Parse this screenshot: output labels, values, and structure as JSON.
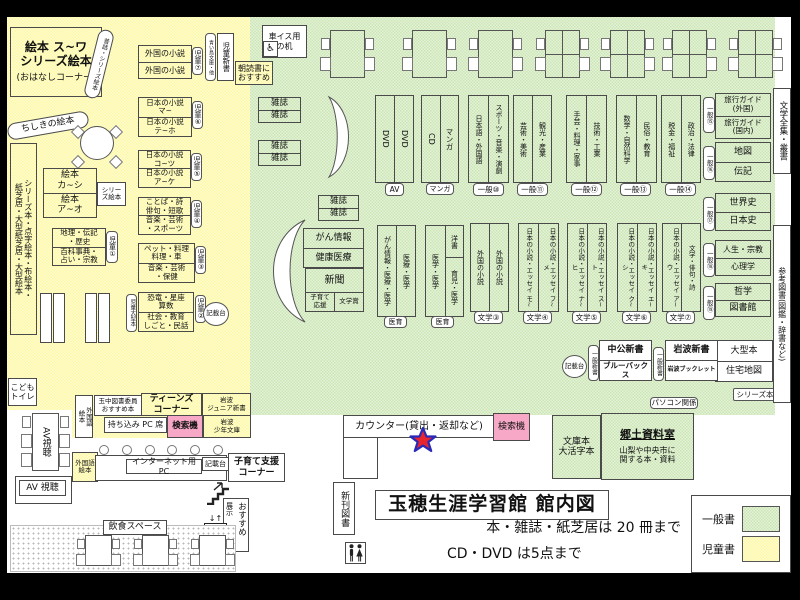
{
  "colors": {
    "children_zone": "#fcf9a2",
    "general_zone": "#cbe5b5",
    "search_machine": "#f6a8c6",
    "star_fill": "#e8252d",
    "star_outline": "#2a2ab8"
  },
  "legend": {
    "general_label": "一般書",
    "children_label": "児童書"
  },
  "title": {
    "main": "玉穂生涯学習館 館内図",
    "note1": "本・雑誌・紙芝居は 20 冊まで",
    "note2": "CD・DVD は5点まで"
  },
  "icons": {
    "wheelchair": "♿",
    "elevator_arrows": "↓↑"
  },
  "children": {
    "corner_line1": "絵本 ス~ワ",
    "corner_line2": "シリーズ絵本",
    "corner_sub": "(おはなしコーナー)",
    "corner_curve": "昔話・シリーズ絵本",
    "chishiki": "ちしきの絵本",
    "series_bar": "シリーズ本・点字絵本・布絵本・\n紙芝居・大型紙芝居・大型絵本",
    "foreign": {
      "a": "外国の小説",
      "b": "外国の小説",
      "tag": "児童⑦"
    },
    "aoitori": "青い鳥文庫・他",
    "jido_shinsho": "児童新書",
    "asadoku": "朝読書に\nおすすめ",
    "jp1": {
      "a": "日本の小説\nマ~",
      "b": "日本の小説\nテ~ホ",
      "tag": "児童⑥"
    },
    "jp2": {
      "a": "日本の小説\nコ~ツ",
      "b": "日本の小説\nア~ケ",
      "tag": "児童⑤"
    },
    "kotoba": {
      "a": "ことば・詩\n俳句・短歌",
      "b": "音楽・芸術\n・スポーツ",
      "tag": "児童④"
    },
    "pet": {
      "a": "ペット・料理\n料理・車",
      "b": "音楽・芸術\n・保健",
      "tag": "児童③"
    },
    "kyoryu": {
      "a": "恐竜・星座\n算数",
      "b": "社会・教育\nしごと・民話",
      "tag": "児童②",
      "side_tag": "児童大型本"
    },
    "chiri": {
      "a": "地理・伝記\n・歴史",
      "b": "百科事典・\n占い・宗教",
      "tag": "児童①"
    },
    "ehon": {
      "a": "絵本\nカ~シ",
      "b": "絵本\nア~オ",
      "series": "シリーズ絵本"
    },
    "kisaidai": "記載台",
    "toilet": "こども\nトイレ"
  },
  "general": {
    "wheelchair_desk": "車イス用\nの机",
    "magazine": "雑誌",
    "gan": {
      "a": "がん情報",
      "b": "健康医療"
    },
    "news": {
      "main": "新聞",
      "left": "子育て\n応援",
      "right": "文学賞"
    },
    "av": {
      "a": "DVD",
      "b": "DVD",
      "tag": "AV"
    },
    "cd": {
      "a": "CD",
      "b": "マンガ",
      "tag": "マンガ"
    },
    "g10": {
      "a": "日本語・外国語",
      "b": "スポーツ・音楽・演劇",
      "tag": "一般⑩"
    },
    "g11": {
      "a": "芸術・美術",
      "b": "観光・産業",
      "tag": "一般⑪"
    },
    "g12": {
      "a": "手芸・料理・家事",
      "b": "技術・工業",
      "tag": "一般⑫"
    },
    "g13": {
      "a": "数学・自然科学",
      "b": "民俗・教育",
      "tag": "一般⑬"
    },
    "g14": {
      "a": "税金・福祉",
      "b": "政治・法律",
      "tag": "一般⑭"
    },
    "g15": {
      "a": "旅行ガイド\n(外国)",
      "b": "旅行ガイド\n(国内)",
      "tag": "一般⑮"
    },
    "g16": {
      "a": "地図",
      "b": "伝記",
      "tag": "一般⑯"
    },
    "g17": {
      "a": "世界史",
      "b": "日本史",
      "tag": "一般⑰"
    },
    "g18": {
      "a": "人生・宗教",
      "b": "心理学",
      "tag": "一般⑱"
    },
    "g19": {
      "a": "哲学",
      "b": "図書館",
      "tag": "一般⑲"
    },
    "ogata": {
      "a": "大型本",
      "b": "住宅地図"
    },
    "med1": {
      "a": "がん情報・医療・医学",
      "b": "医療・医学",
      "tag": "医育"
    },
    "med2": {
      "a": "医学・医学",
      "b_top": "洋書",
      "b_bottom": "育児・医学",
      "tag": "医育"
    },
    "lit3": {
      "a": "外国の小説",
      "b": "外国の小説",
      "tag": "文学③"
    },
    "lit4": {
      "a": "日本の小説・エッセイ モ~",
      "b": "日本の小説・エッセイ フ~メ",
      "tag": "文学④"
    },
    "lit5": {
      "a": "日本の小説・エッセイ ナ~ヒ",
      "b": "日本の小説・エッセイ ス~ト",
      "tag": "文学⑤"
    },
    "lit6": {
      "a": "日本の小説・エッセイ ク~シ",
      "b": "日本の小説・エッセイ エ~キ",
      "tag": "文学⑥"
    },
    "lit7": {
      "a": "日本の小説・エッセイ ア~ウ",
      "b": "文学・俳句・詩",
      "tag": "文学⑦"
    },
    "shinsho_tag": "一般新書",
    "chuko": {
      "a": "中公新書",
      "b": "ブルーバックス"
    },
    "iwanami": {
      "a": "岩波新書",
      "b": "岩波ブックレット"
    },
    "pasokon": "パソコン関係",
    "series_tag": "シリーズ本",
    "bungaku_bar": "文学全集・叢書",
    "sanko_bar": "参考図書(図鑑・辞書など)",
    "kisaidai": "記載台"
  },
  "bottom": {
    "counter": "カウンター(貸出・返却など)",
    "search": "検索機",
    "bunko": "文庫本\n大活字本",
    "kyodo_title": "郷土資料室",
    "kyodo_desc": "山梨や中央市に\n関する本・資料",
    "shinkan": "新刊図書",
    "av_v": "AV視聴",
    "av_h": "AV 視聴",
    "gaikokugo": "外国語\n絵本",
    "tamachu": "玉中図書委員\nおすすめ本",
    "teens": "ティーンズ\nコーナー",
    "iwanami_jr": "岩波\nジュニア新書",
    "iwanami_sho": "岩波\n少年文庫",
    "mochikomi": "持ち込み PC 席",
    "internet": "インターネット用 PC",
    "kisaidai": "記載台",
    "kosodate": "子育て支援\nコーナー",
    "osusume_main": "おすすめ",
    "osusume_sub": "展示",
    "inshoku": "飲食スペース"
  }
}
